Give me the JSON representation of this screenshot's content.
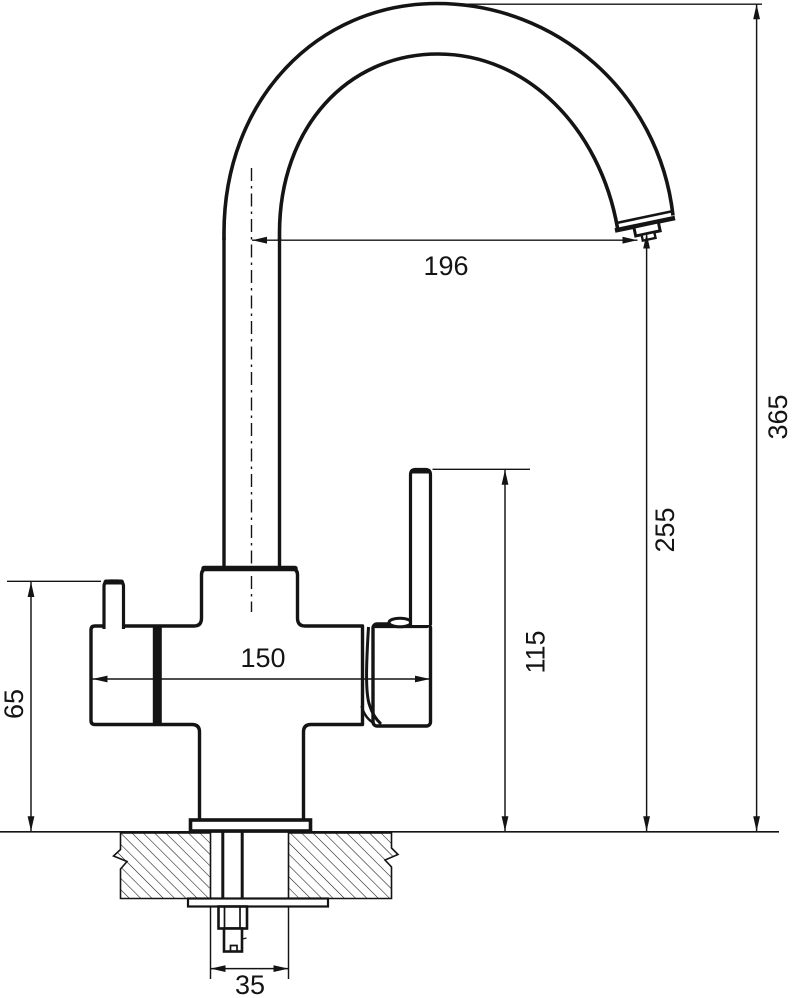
{
  "page": {
    "background": "#ffffff",
    "line_color": "#141414"
  },
  "drawing": {
    "kind": "faucet dimension drawing",
    "dimensions": {
      "spout_reach": "196",
      "overall_height": "365",
      "spout_outlet_height": "255",
      "lever_top_height": "115",
      "body_width": "150",
      "side_knob_height": "65",
      "mounting_hole_width": "35"
    }
  }
}
